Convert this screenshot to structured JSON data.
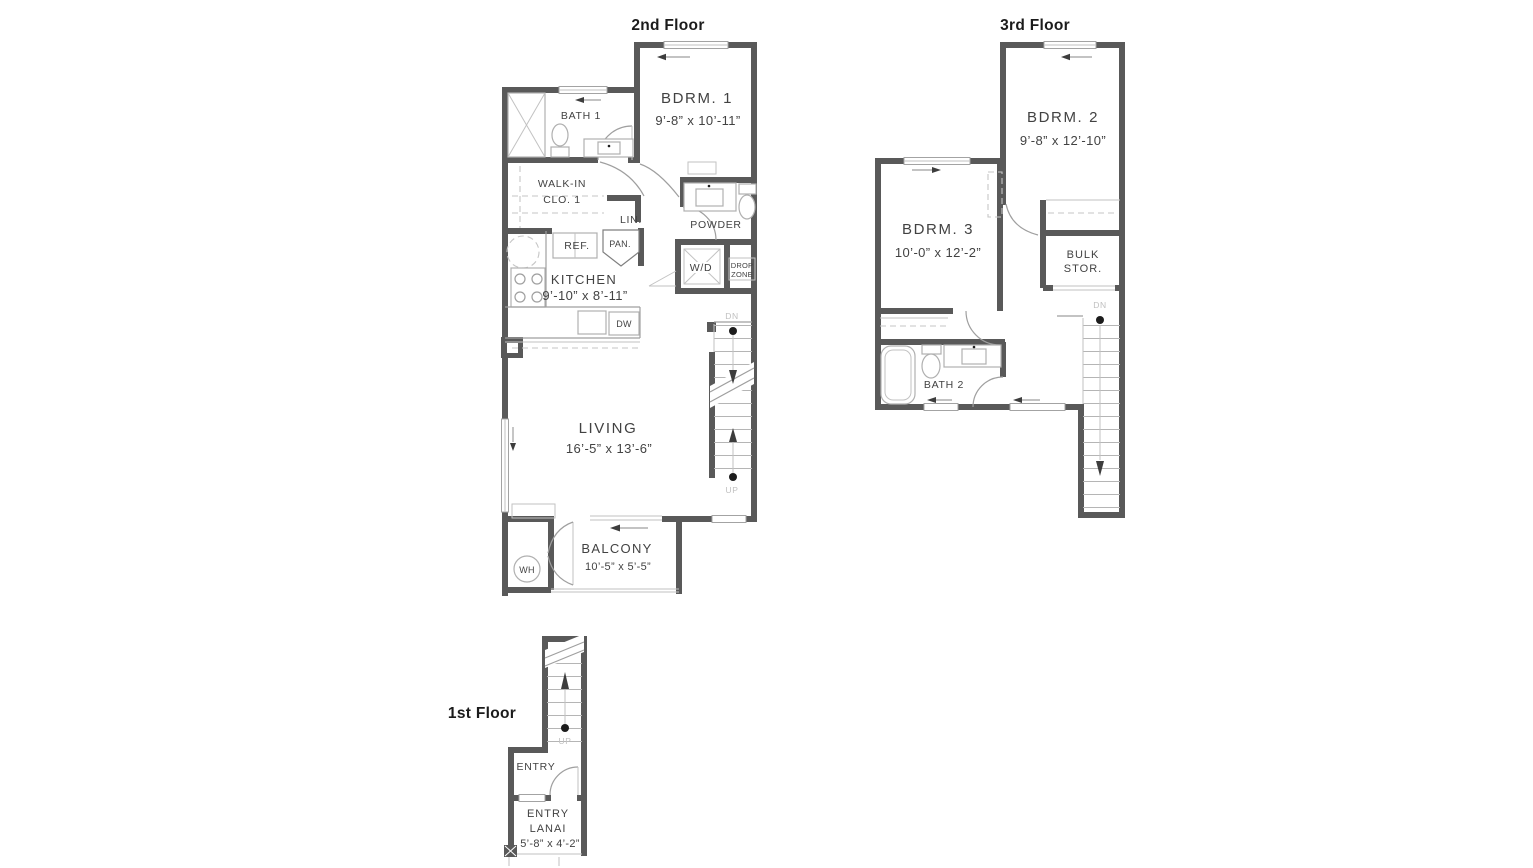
{
  "colors": {
    "wall": "#595959",
    "thin_line": "#9f9f9f",
    "dashed_line": "#c6c6c6",
    "fixture_line": "#b0b0b0",
    "text": "#424242",
    "title_text": "#1b1b1b",
    "stair_label": "#c0c0c0",
    "background": "#ffffff"
  },
  "floors": {
    "second": {
      "title": "2nd Floor",
      "bdrm1": {
        "name": "BDRM. 1",
        "dims": "9’-8” x 10’-11”"
      },
      "bath1": {
        "name": "BATH 1"
      },
      "walkin": {
        "line1": "WALK-IN",
        "line2": "CLO. 1"
      },
      "lin": {
        "name": "LIN."
      },
      "powder": {
        "name": "POWDER"
      },
      "ref": {
        "name": "REF."
      },
      "pan": {
        "name": "PAN."
      },
      "wd": {
        "name": "W/D"
      },
      "dropzone": {
        "line1": "DROP",
        "line2": "ZONE"
      },
      "kitchen": {
        "name": "KITCHEN",
        "dims": "9’-10” x 8’-11”"
      },
      "dw": {
        "name": "DW"
      },
      "living": {
        "name": "LIVING",
        "dims": "16’-5” x 13’-6”"
      },
      "balcony": {
        "name": "BALCONY",
        "dims": "10’-5” x 5’-5”"
      },
      "wh": {
        "name": "WH"
      },
      "stairs": {
        "dn": "DN",
        "up": "UP"
      }
    },
    "third": {
      "title": "3rd Floor",
      "bdrm2": {
        "name": "BDRM. 2",
        "dims": "9’-8” x 12’-10”"
      },
      "bdrm3": {
        "name": "BDRM. 3",
        "dims": "10’-0” x 12’-2”"
      },
      "bulk": {
        "line1": "BULK",
        "line2": "STOR."
      },
      "bath2": {
        "name": "BATH 2"
      },
      "stairs": {
        "dn": "DN"
      }
    },
    "first": {
      "title": "1st Floor",
      "entry": {
        "name": "ENTRY"
      },
      "lanai": {
        "line1": "ENTRY",
        "line2": "LANAI",
        "dims": "5’-8” x 4’-2”"
      },
      "stairs": {
        "up": "UP"
      }
    }
  }
}
